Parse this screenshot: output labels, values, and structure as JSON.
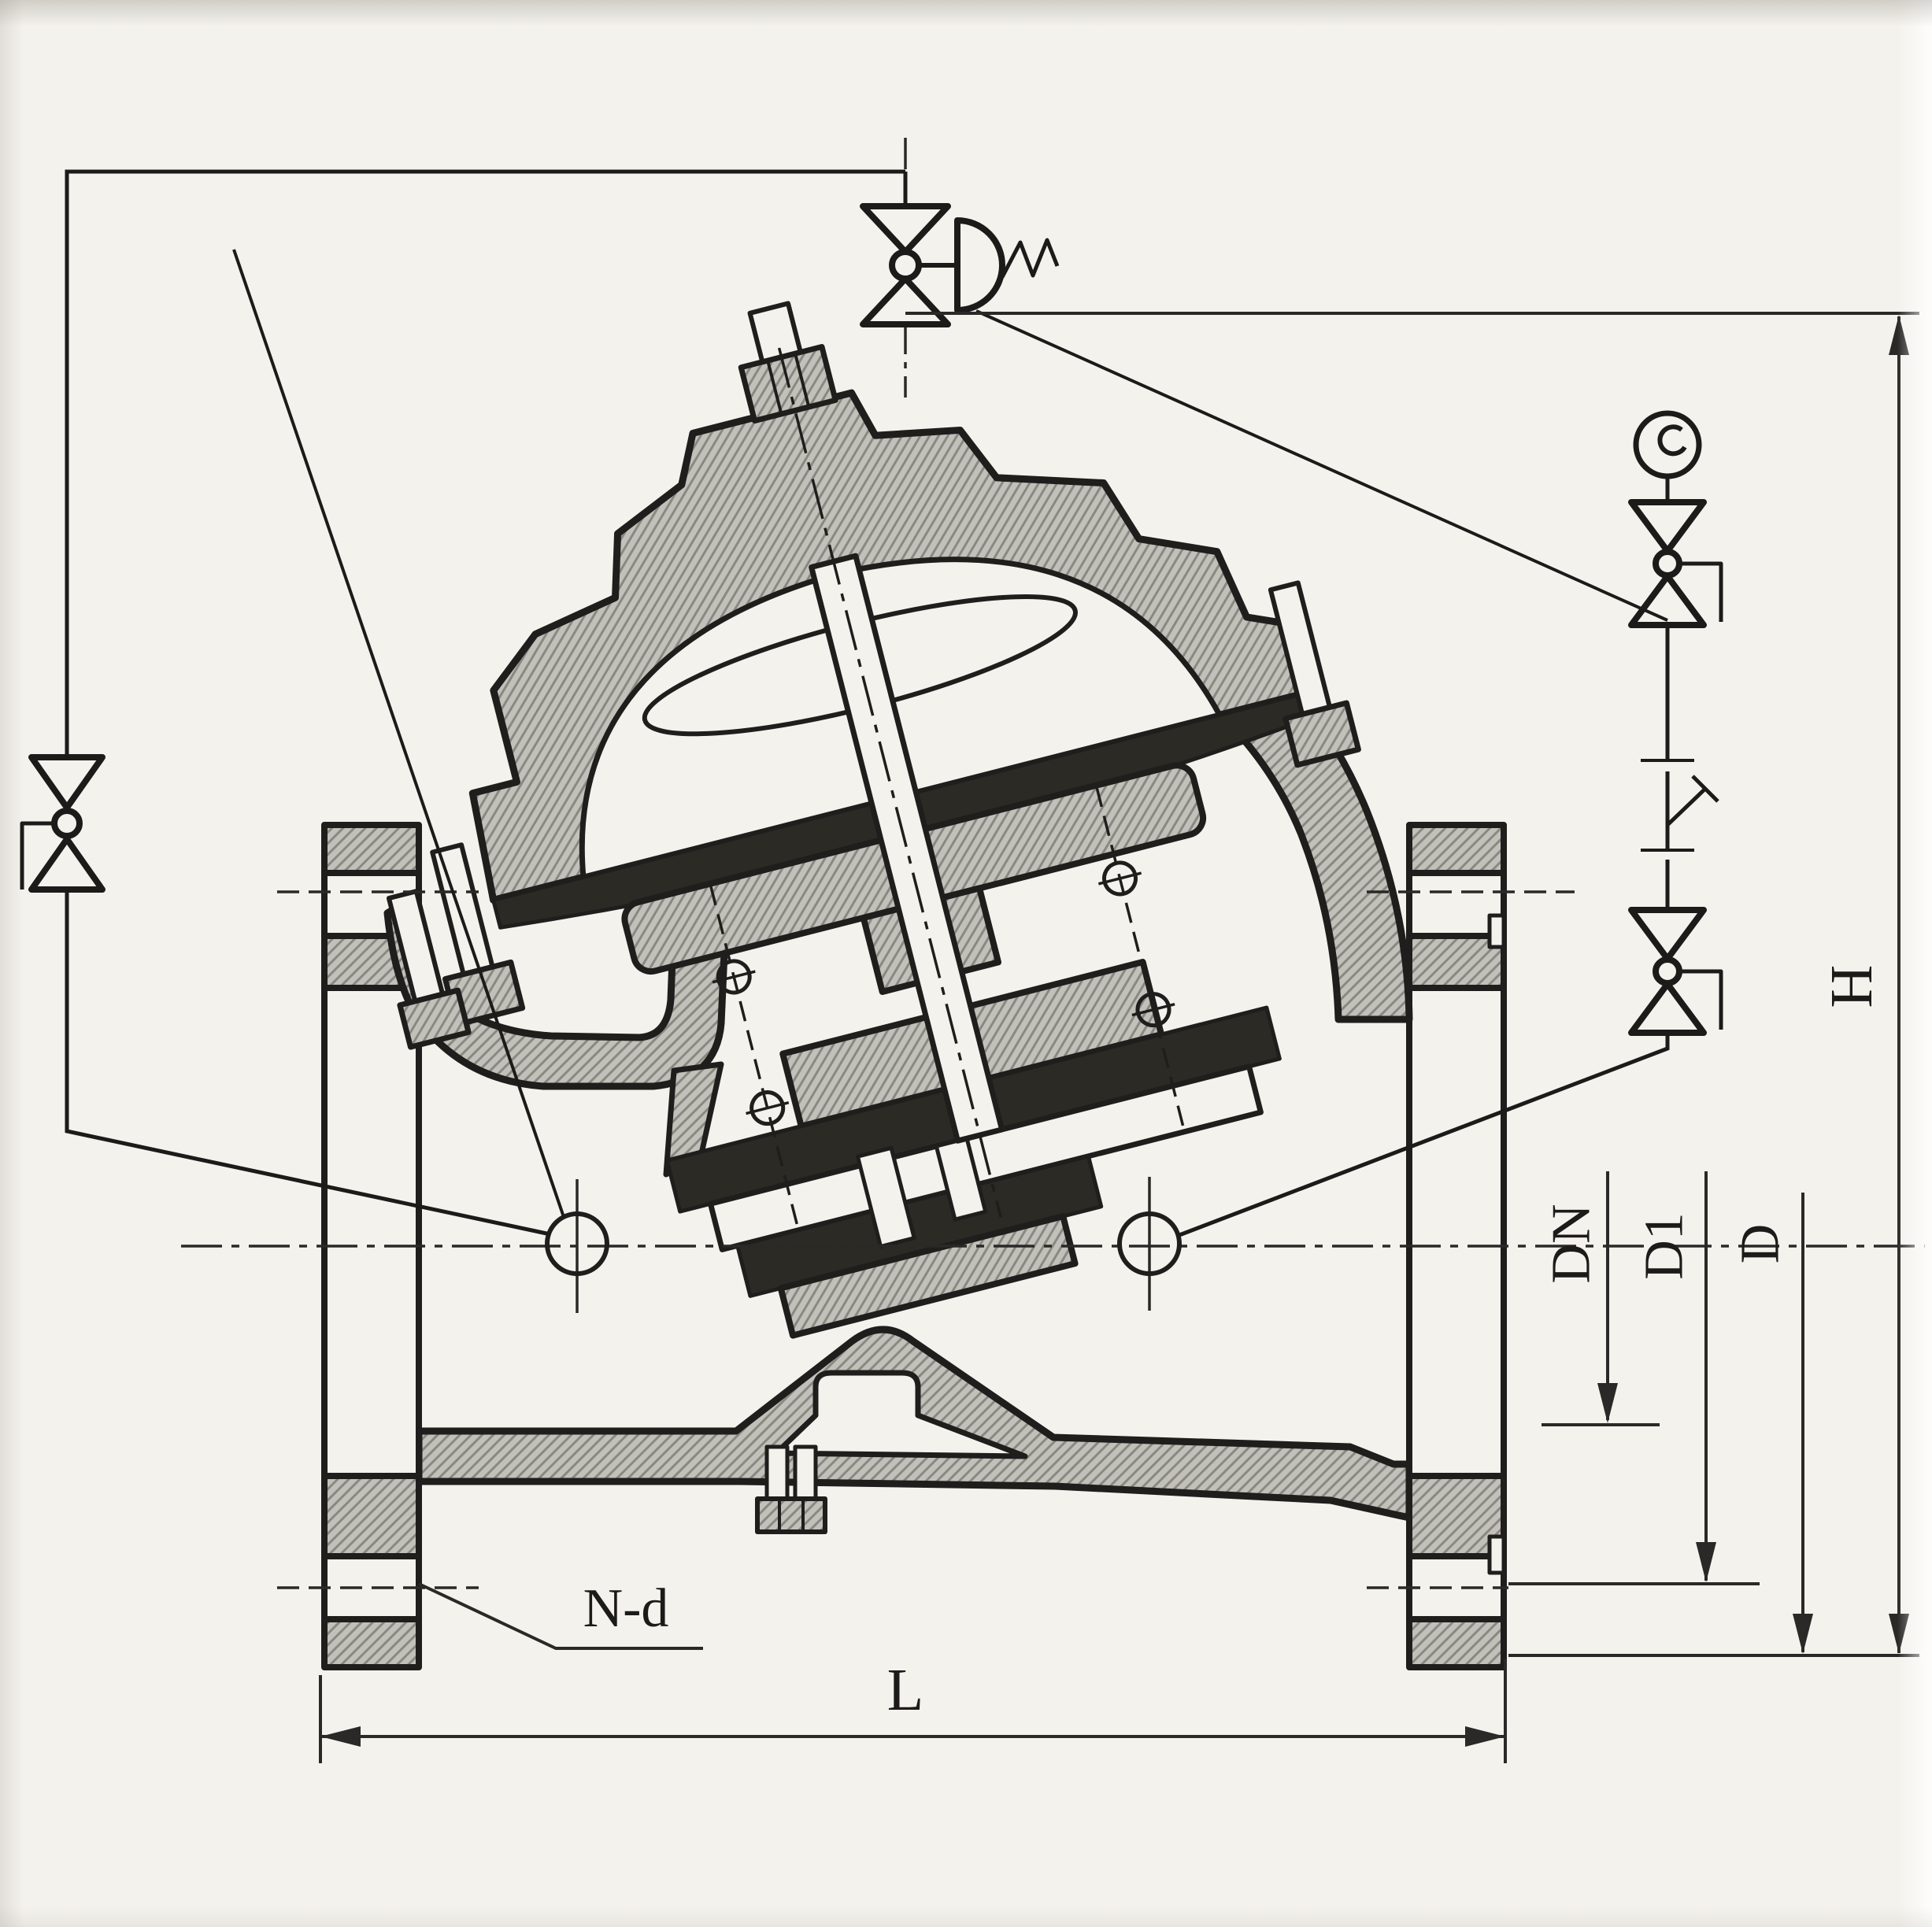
{
  "drawing": {
    "kind": "diaphragm pump-control valve cross-section (engineering drawing)",
    "labels": {
      "H": "H",
      "L": "L",
      "DN": "DN",
      "D1": "D1",
      "D": "D",
      "Nd": "N-d"
    },
    "icons": [
      "globe-valve-symbol-top",
      "globe-valve-symbol-left",
      "globe-valve-symbol-right-upper",
      "globe-valve-symbol-right-lower",
      "pressure-gauge-icon",
      "diaphragm-pilot-icon"
    ],
    "colors": {
      "paper": "#f4f2ed",
      "ink": "#1f1e1c",
      "section_hatch_base": "#c1c0bb",
      "section_hatch_line": "#8a897f",
      "seal_dark": "#2b2a24"
    }
  }
}
